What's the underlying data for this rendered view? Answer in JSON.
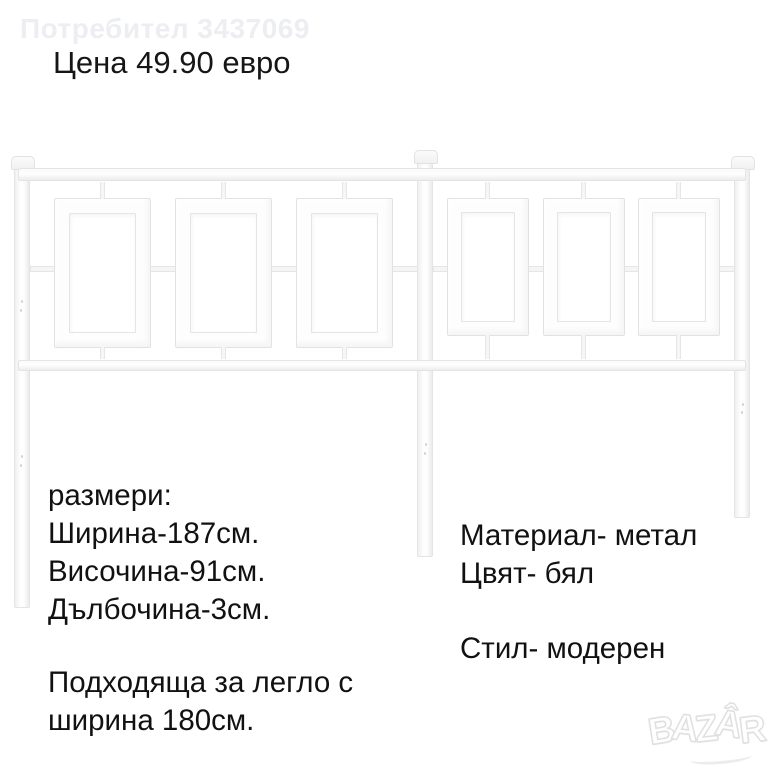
{
  "canvas": {
    "background": "#ffffff"
  },
  "header": {
    "user_watermark": "Потребител 3437069",
    "price": "Цена 49.90 евро"
  },
  "photo": {
    "subject": "white-metal-headboard",
    "metal_color": "#ffffff",
    "edge_color": "#e4e4e4"
  },
  "details": {
    "sizes_title": "размери:",
    "width": "Ширина-187см.",
    "height": "Височина-91см.",
    "depth": "Дълбочина-3см.",
    "fit_line1": "Подходяща за легло с",
    "fit_line2": "ширина 180см.",
    "material": "Материал- метал",
    "color": "Цвят- бял",
    "style": "Стил- модерен"
  },
  "brand": {
    "name": "BAZAR",
    "letters": [
      "B",
      "A",
      "Z",
      "Â",
      "R"
    ]
  }
}
